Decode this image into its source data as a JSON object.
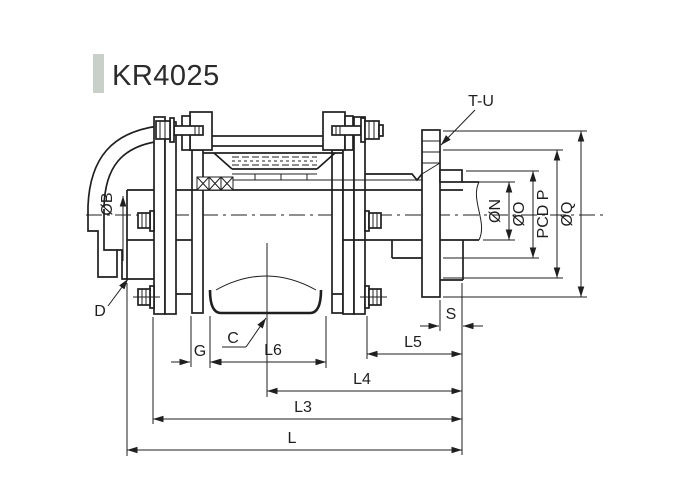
{
  "window": {
    "width": 700,
    "height": 500,
    "background": "#ffffff"
  },
  "header": {
    "model": "KR4025",
    "accent_bar_color": "#c9cfc9",
    "text_color": "#2b2b2b"
  },
  "drawing": {
    "kind": "coupling cross-section technical drawing",
    "line_color": "#1f1f1f",
    "callouts": {
      "thread": "T-U",
      "bore": "ØB",
      "housing": "D",
      "sleeve": "C"
    },
    "dims_bottom": {
      "g": "G",
      "l6": "L6",
      "s": "S",
      "l5": "L5",
      "l4": "L4",
      "l3": "L3",
      "l": "L"
    },
    "dims_right": {
      "n": "ØN",
      "o": "ØO",
      "p": "PCD P",
      "q": "ØQ"
    }
  }
}
